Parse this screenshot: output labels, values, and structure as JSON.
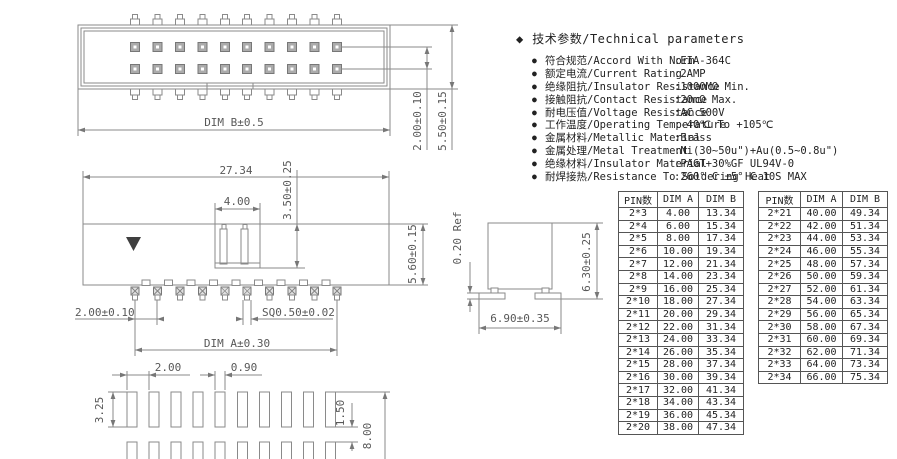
{
  "icons": {
    "diamond": "◆",
    "bullet": "●"
  },
  "parameters": {
    "title": "技术参数/Technical parameters",
    "items": [
      {
        "label": "符合规范/Accord With Norm",
        "value": ":EIA-364C"
      },
      {
        "label": "额定电流/Current Rating",
        "value": ":2AMP"
      },
      {
        "label": "绝缘阻抗/Insulator Resistance",
        "value": ":1000MΩ Min."
      },
      {
        "label": "接触阻抗/Contact Resistance",
        "value": ":20mΩ Max."
      },
      {
        "label": "耐电压值/Voltage Resistance",
        "value": ":AC 500V"
      },
      {
        "label": "工作温度/Operating Temperature",
        "value": ":-40℃ To +105℃"
      },
      {
        "label": "金属材料/Metallic Material",
        "value": ":Brass"
      },
      {
        "label": "金属处理/Metal Treatment",
        "value": ":Ni(30~50u\")+Au(0.5~0.8u\")"
      },
      {
        "label": "绝缘材料/Insulator Material",
        "value": ":PA6T+30%GF UL94V-0"
      },
      {
        "label": "耐焊接热/Resistance To Soldering Heat",
        "value": ":260° C ±5° C  10S MAX"
      }
    ]
  },
  "tables": {
    "table1": {
      "headers": [
        "PIN数",
        "DIM A",
        "DIM B"
      ],
      "rows": [
        [
          "2*3",
          "4.00",
          "13.34"
        ],
        [
          "2*4",
          "6.00",
          "15.34"
        ],
        [
          "2*5",
          "8.00",
          "17.34"
        ],
        [
          "2*6",
          "10.00",
          "19.34"
        ],
        [
          "2*7",
          "12.00",
          "21.34"
        ],
        [
          "2*8",
          "14.00",
          "23.34"
        ],
        [
          "2*9",
          "16.00",
          "25.34"
        ],
        [
          "2*10",
          "18.00",
          "27.34"
        ],
        [
          "2*11",
          "20.00",
          "29.34"
        ],
        [
          "2*12",
          "22.00",
          "31.34"
        ],
        [
          "2*13",
          "24.00",
          "33.34"
        ],
        [
          "2*14",
          "26.00",
          "35.34"
        ],
        [
          "2*15",
          "28.00",
          "37.34"
        ],
        [
          "2*16",
          "30.00",
          "39.34"
        ],
        [
          "2*17",
          "32.00",
          "41.34"
        ],
        [
          "2*18",
          "34.00",
          "43.34"
        ],
        [
          "2*19",
          "36.00",
          "45.34"
        ],
        [
          "2*20",
          "38.00",
          "47.34"
        ]
      ]
    },
    "table2": {
      "headers": [
        "PIN数",
        "DIM A",
        "DIM B"
      ],
      "rows": [
        [
          "2*21",
          "40.00",
          "49.34"
        ],
        [
          "2*22",
          "42.00",
          "51.34"
        ],
        [
          "2*23",
          "44.00",
          "53.34"
        ],
        [
          "2*24",
          "46.00",
          "55.34"
        ],
        [
          "2*25",
          "48.00",
          "57.34"
        ],
        [
          "2*26",
          "50.00",
          "59.34"
        ],
        [
          "2*27",
          "52.00",
          "61.34"
        ],
        [
          "2*28",
          "54.00",
          "63.34"
        ],
        [
          "2*29",
          "56.00",
          "65.34"
        ],
        [
          "2*30",
          "58.00",
          "67.34"
        ],
        [
          "2*31",
          "60.00",
          "69.34"
        ],
        [
          "2*32",
          "62.00",
          "71.34"
        ],
        [
          "2*33",
          "64.00",
          "73.34"
        ],
        [
          "2*34",
          "66.00",
          "75.34"
        ]
      ]
    }
  },
  "drawing": {
    "top_view": {
      "dim_b": "DIM B±0.5",
      "dim_row_pitch": "2.00±0.10",
      "dim_height": "5.50±0.15"
    },
    "side_view": {
      "dim_overall_width": "27.34",
      "dim_key_width": "4.00",
      "dim_key_depth": "3.50±0.25",
      "dim_body_height": "5.60±0.15",
      "dim_pin_pitch": "2.00±0.10",
      "dim_pin_size": "SQ0.50±0.02",
      "dim_a": "DIM A±0.30"
    },
    "end_view": {
      "dim_standoff": "0.20 Ref",
      "dim_height": "6.30±0.25",
      "dim_width": "6.90±0.35"
    },
    "footprint": {
      "dim_pitch": "2.00",
      "dim_pad_width": "0.90",
      "dim_pad_height": "3.25",
      "dim_row_gap": "1.50",
      "dim_span": "8.00"
    }
  }
}
